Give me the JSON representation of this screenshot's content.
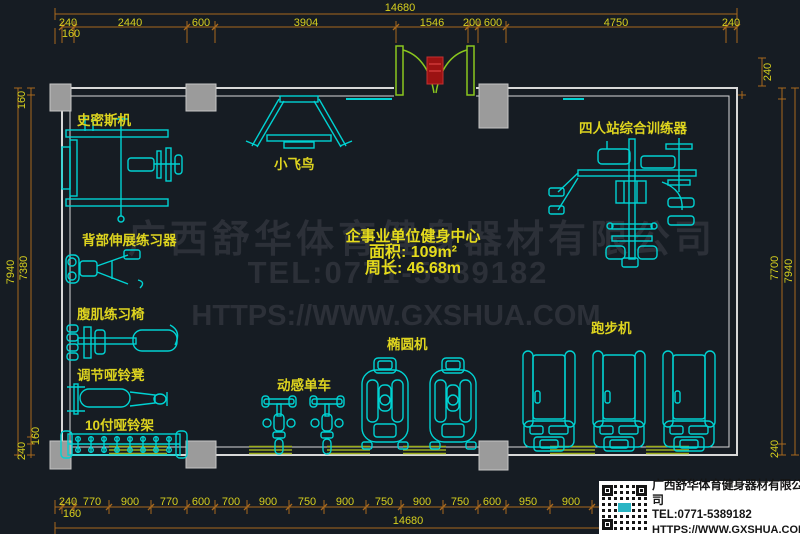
{
  "colors": {
    "background": "#161c23",
    "equipment_line": "#00d2d2",
    "label_yellow": "#ded41f",
    "dim_line_orange": "#a8691e",
    "dim_text_yellow": "#d6cf1e",
    "wall_gray": "#d8d8d8",
    "column_gray": "#9b9b9b",
    "door_green": "#8ac61e",
    "window_green": "#9aab1c",
    "cooler_red": "#9c1212",
    "watermark_gray": "#2c3038",
    "infobox_bg": "#ffffff"
  },
  "watermark": {
    "company": "广西舒华体育健身器材有限公司",
    "tel": "TEL:0771-5389182",
    "url": "HTTPS://WWW.GXSHUA.COM"
  },
  "center_info": {
    "title": "企事业单位健身中心",
    "area": "面积: 109m²",
    "perimeter": "周长: 46.68m"
  },
  "equipment": {
    "smith": "史密斯机",
    "fly": "小飞鸟",
    "multi": "四人站综合训练器",
    "back": "背部伸展练习器",
    "ab": "腹肌练习椅",
    "bench": "调节哑铃凳",
    "rack": "10付哑铃架",
    "bike": "动感单车",
    "elliptical": "椭圆机",
    "treadmill": "跑步机"
  },
  "dimensions": {
    "top_total": "14680",
    "top_row": [
      "240",
      "2440",
      "600",
      "3904",
      "1546",
      "200",
      "600",
      "4750",
      "240"
    ],
    "top_inner": "160",
    "bottom_row": [
      "240",
      "770",
      "900",
      "770",
      "600",
      "700",
      "900",
      "750",
      "900",
      "750",
      "900",
      "750",
      "600",
      "950",
      "900"
    ],
    "bottom_inner": "160",
    "bottom_total": "14680",
    "left": {
      "top_inner": "160",
      "outer": "7940",
      "inner": "7380",
      "bottom_inner": "160",
      "bottom_corner": "240"
    },
    "right": {
      "top": "240",
      "inner": "7700",
      "outer": "7940",
      "bottom": "240"
    }
  },
  "info_box": {
    "company": "广西舒华体育健身器材有限公司",
    "tel": "TEL:0771-5389182",
    "url": "HTTPS://WWW.GXSHUA.COM"
  }
}
